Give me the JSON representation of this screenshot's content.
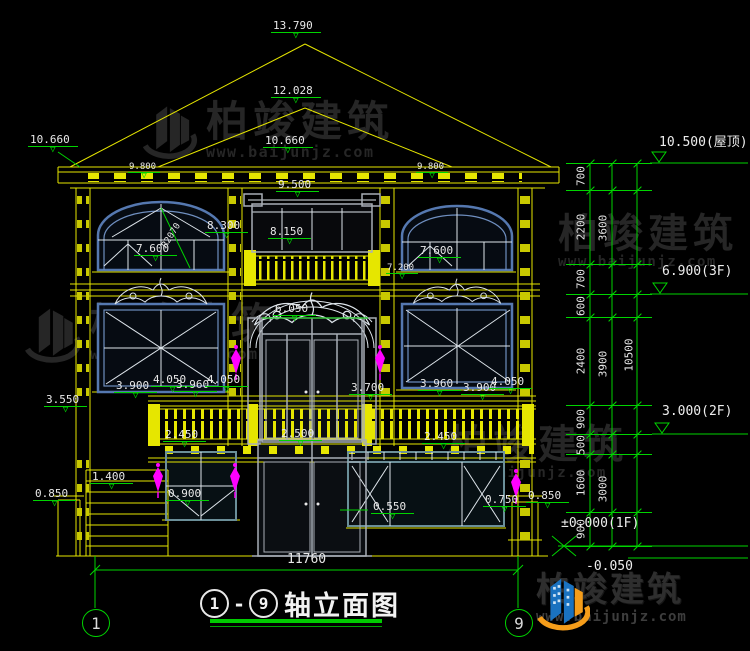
{
  "meta": {
    "axis_start": "1",
    "axis_end": "9",
    "title": "轴立面图"
  },
  "brand": {
    "name": "柏竣建筑",
    "url": "www.baijunjz.com"
  },
  "drawing": {
    "markers": [
      {
        "label": "13.790",
        "x": 271,
        "y": 20
      },
      {
        "label": "12.028",
        "x": 271,
        "y": 85
      },
      {
        "label": "10.660",
        "x": 263,
        "y": 135
      },
      {
        "label": "10.660",
        "x": 28,
        "y": 134
      },
      {
        "label": "9.800",
        "x": 128,
        "y": 163,
        "small": true
      },
      {
        "label": "9.800",
        "x": 416,
        "y": 163,
        "small": true
      },
      {
        "label": "9.500",
        "x": 276,
        "y": 179
      },
      {
        "label": "8.300",
        "x": 205,
        "y": 220
      },
      {
        "label": "8.150",
        "x": 268,
        "y": 226
      },
      {
        "label": "7.600",
        "x": 134,
        "y": 243
      },
      {
        "label": "7.600",
        "x": 418,
        "y": 245
      },
      {
        "label": "7.200",
        "x": 386,
        "y": 264,
        "small": true
      },
      {
        "label": "6.050",
        "x": 273,
        "y": 303
      },
      {
        "label": "3.550",
        "x": 44,
        "y": 394
      },
      {
        "label": "3.900",
        "x": 114,
        "y": 380
      },
      {
        "label": "4.050",
        "x": 151,
        "y": 374
      },
      {
        "label": "3.960",
        "x": 174,
        "y": 379
      },
      {
        "label": "4.050",
        "x": 205,
        "y": 374
      },
      {
        "label": "3.700",
        "x": 349,
        "y": 382
      },
      {
        "label": "3.960",
        "x": 418,
        "y": 378
      },
      {
        "label": "3.900",
        "x": 461,
        "y": 382
      },
      {
        "label": "4.050",
        "x": 489,
        "y": 376
      },
      {
        "label": "2.450",
        "x": 163,
        "y": 429
      },
      {
        "label": "2.500",
        "x": 279,
        "y": 428
      },
      {
        "label": "2.450",
        "x": 422,
        "y": 431
      },
      {
        "label": "1.400",
        "x": 90,
        "y": 471
      },
      {
        "label": "0.850",
        "x": 33,
        "y": 488
      },
      {
        "label": "0.900",
        "x": 166,
        "y": 488
      },
      {
        "label": "0.550",
        "x": 371,
        "y": 501
      },
      {
        "label": "0.750",
        "x": 483,
        "y": 494
      },
      {
        "label": "0.850",
        "x": 526,
        "y": 490
      }
    ],
    "radius_label": {
      "label": "R2070",
      "x": 172,
      "y": 236,
      "rot": -58
    },
    "axis_bubbles": [
      {
        "label": "1",
        "x": 95,
        "y": 622
      },
      {
        "label": "9",
        "x": 518,
        "y": 622
      }
    ],
    "bottom_dim": {
      "label": "11760",
      "tx": 287,
      "ty": 552
    }
  },
  "right_rail": {
    "inner_segments": [
      {
        "label": "700",
        "y": 176
      },
      {
        "label": "2200",
        "y": 227
      },
      {
        "label": "700",
        "y": 279
      },
      {
        "label": "600",
        "y": 306
      },
      {
        "label": "2400",
        "y": 361
      },
      {
        "label": "900",
        "y": 419
      },
      {
        "label": "500",
        "y": 445
      },
      {
        "label": "1600",
        "y": 483
      },
      {
        "label": "900",
        "y": 529
      }
    ],
    "mid_segments": [
      {
        "label": "3600",
        "y": 228
      },
      {
        "label": "3900",
        "y": 364
      },
      {
        "label": "3000",
        "y": 489
      }
    ],
    "outer_segments": [
      {
        "label": "10500",
        "y": 355
      }
    ],
    "ticks": [
      163,
      190,
      264,
      294,
      317,
      405,
      434,
      454,
      512,
      546
    ],
    "levels": [
      {
        "label": "10.500(屋顶)",
        "x": 659,
        "y": 136
      },
      {
        "label": "6.900(3F)",
        "x": 662,
        "y": 265
      },
      {
        "label": "3.000(2F)",
        "x": 662,
        "y": 405
      },
      {
        "label": "±0.000(1F)",
        "x": 561,
        "y": 517
      },
      {
        "label": "-0.050",
        "x": 586,
        "y": 560
      }
    ]
  }
}
